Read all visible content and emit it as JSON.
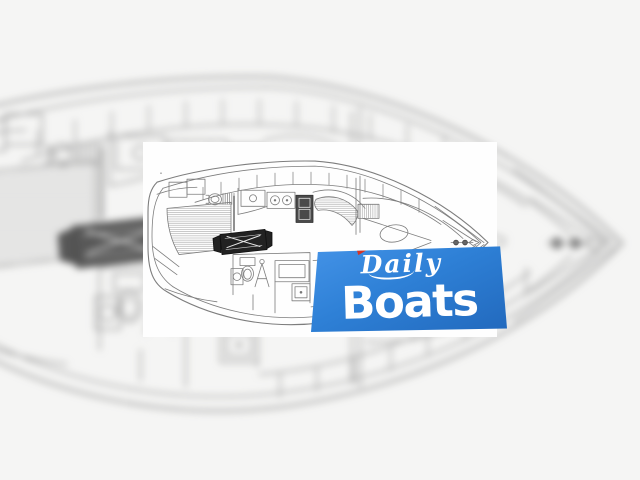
{
  "photo": {
    "type": "boat-floorplan-line-drawing",
    "description": "Hand-drawn top-down interior layout of a sailing yacht: aft cabin with shaded double berth and oval vanity sink, galley with two-burner stove and dark appliance unit, saloon with black folding table and curved settee, enclosed head with toilet, sink and shower, forward V-berth cabin with hatched locker, bow anchor fitting",
    "background": "enlarged blurred copy of the same floor plan"
  },
  "watermark": {
    "brand_script": "Daily",
    "brand_main": "Boats",
    "flag_icon": "red-pennant-icon",
    "colors": {
      "panel_blue": "#2e80d6",
      "panel_blue_dark": "#2269bd",
      "flag_red": "#d63324",
      "text": "#ffffff"
    }
  }
}
